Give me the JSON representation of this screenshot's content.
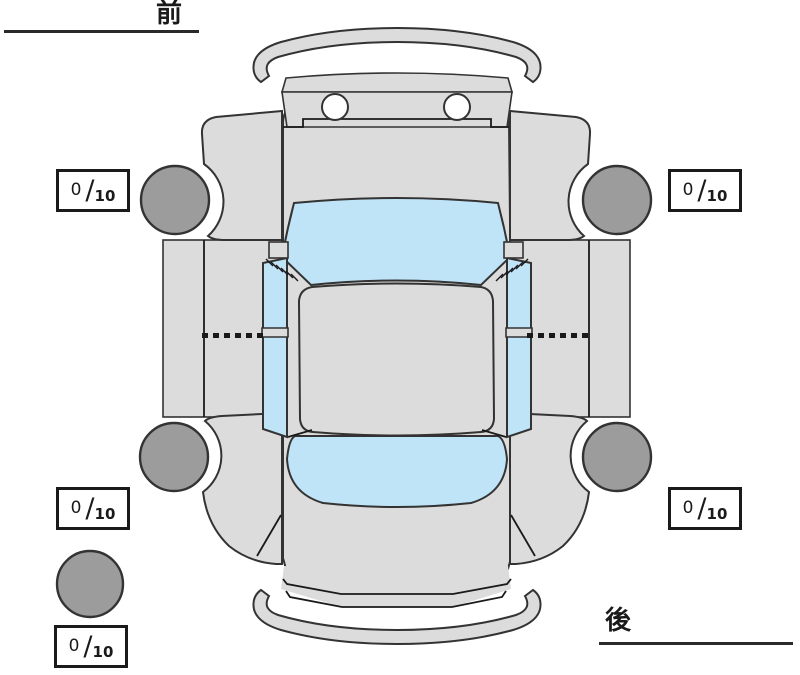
{
  "labels": {
    "front": "前",
    "rear": "後"
  },
  "score_boxes": [
    {
      "id": "front-left",
      "value": "0",
      "separator": "/",
      "max": "10"
    },
    {
      "id": "front-right",
      "value": "0",
      "separator": "/",
      "max": "10"
    },
    {
      "id": "rear-left",
      "value": "0",
      "separator": "/",
      "max": "10"
    },
    {
      "id": "rear-right",
      "value": "0",
      "separator": "/",
      "max": "10"
    },
    {
      "id": "spare",
      "value": "0",
      "separator": "/",
      "max": "10"
    }
  ],
  "diagram": {
    "type": "vehicle-top-view-condition-map",
    "tires": [
      "front-left",
      "front-right",
      "rear-left",
      "rear-right",
      "spare"
    ],
    "colors": {
      "body": "#dcdcdc",
      "glass": "#bfe3f7",
      "tire": "#9c9c9c",
      "outline": "#333333",
      "line": "#1a1a1a",
      "box_border": "#1a1a1a",
      "background": "#ffffff",
      "text": "#1a1a1a"
    }
  }
}
